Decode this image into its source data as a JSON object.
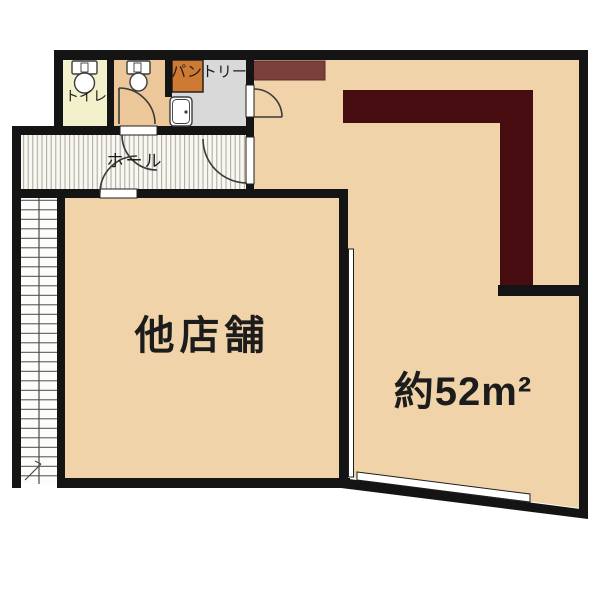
{
  "plan": {
    "type": "floor-plan",
    "labels": {
      "toilet": "トイレ",
      "pantry": "パントリー",
      "hall": "ホール",
      "other_shop": "他店舗",
      "main_area": "約52m²"
    },
    "rooms": [
      {
        "id": "toilet",
        "label": "トイレ",
        "fixtures": [
          "toilet"
        ]
      },
      {
        "id": "second-toilet",
        "label": "",
        "fixtures": [
          "toilet",
          "door"
        ]
      },
      {
        "id": "pantry",
        "label": "パントリー",
        "fixtures": [
          "pantry-shelf",
          "sink",
          "door"
        ]
      },
      {
        "id": "hall",
        "label": "ホール",
        "fixtures": [
          "door-to-shop",
          "door-to-main"
        ]
      },
      {
        "id": "other-shop",
        "label": "他店舗",
        "fixtures": []
      },
      {
        "id": "main-room",
        "label": "約52m²",
        "fixtures": [
          "l-counter",
          "shelf",
          "window"
        ]
      },
      {
        "id": "staircase",
        "label": "",
        "fixtures": [
          "stairs"
        ]
      }
    ]
  },
  "palette": {
    "bg": "#ffffff",
    "wall": "#141414",
    "floor": "#f0d3a8",
    "floor_room2": "#ebc79a",
    "floor_toilet": "#f2f1cb",
    "floor_pantry": "#d9d9d9",
    "pantry_box": "#ce7a33",
    "counter": "#470c10",
    "shelf": "#7c403a",
    "hall_bg": "#f8f7f1",
    "hall_stripe": "#aba79c",
    "stair_line": "#4a4a46",
    "door_line": "#3a3a3a",
    "label": "#1c1c1c"
  }
}
